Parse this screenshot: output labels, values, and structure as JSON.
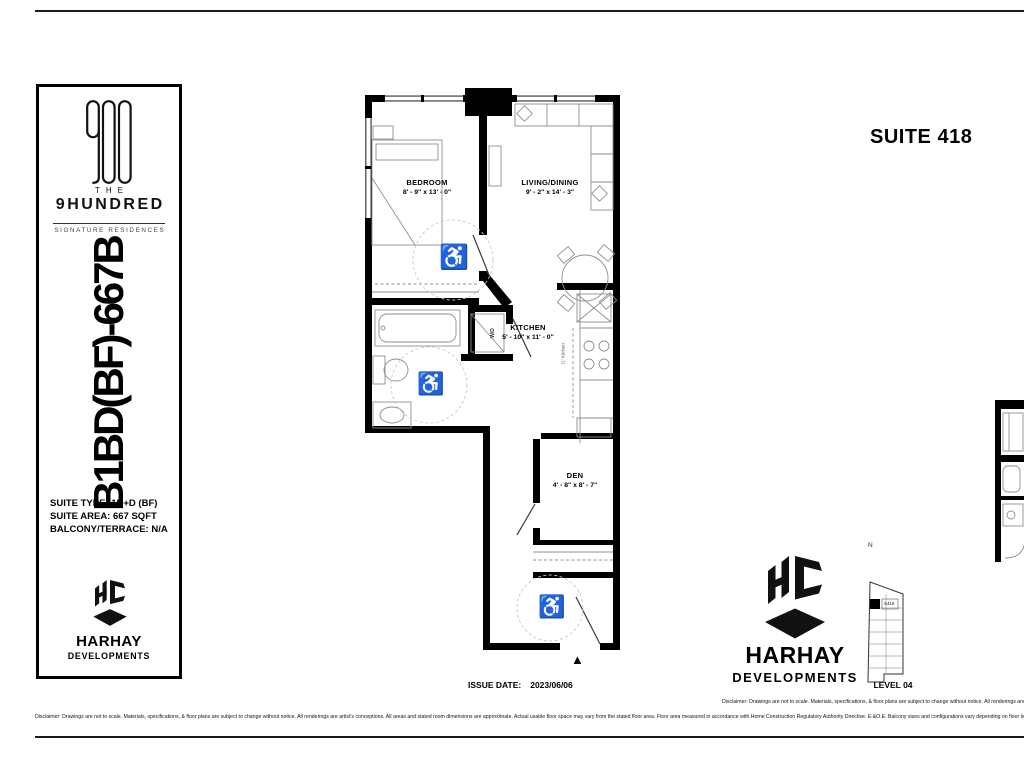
{
  "sheet": {
    "suite_title": "SUITE 418",
    "issue_date_label": "ISSUE DATE:",
    "issue_date_value": "2023/06/06",
    "disclaimer": "Disclaimer: Drawings are not to scale. Materials, specifications, & floor plans are subject to change without notice. All renderings are artist's conceptions. All areas and stated room dimensions are approximate. Actual usable floor space may vary from the stated floor area. Floor area measured in accordance with Home Construction Regulatory Authority Directive. E.&O.E. Balcony sizes and configurations vary depending on floor level locations."
  },
  "sidebar": {
    "brand_the": "THE",
    "brand_name": "9HUNDRED",
    "brand_sub": "SIGNATURE RESIDENCES",
    "plan_code": "B1BD(BF)-667B",
    "suite_type": "SUITE TYPE: 1B+D (BF)",
    "suite_area": "SUITE AREA: 667 SQFT",
    "balcony": "BALCONY/TERRACE: N/A",
    "developer_name": "HARHAY",
    "developer_sub": "DEVELOPMENTS"
  },
  "footer_brand": {
    "developer_name": "HARHAY",
    "developer_sub": "DEVELOPMENTS"
  },
  "floorplan": {
    "rooms": [
      {
        "name": "BEDROOM",
        "dims": "8' - 9\" x 13' - 0\""
      },
      {
        "name": "LIVING/DINING",
        "dims": "9' - 2\" x 14' - 3\""
      },
      {
        "name": "KITCHEN",
        "dims": "5' - 10\" x 11' - 0\""
      },
      {
        "name": "DEN",
        "dims": "4' - 8\" x 8' - 7\""
      }
    ],
    "wd_label": "W/D",
    "kitchen_run_label": "11' Kitchen"
  },
  "keyplan": {
    "north_label": "N",
    "suite_label": "S418",
    "level_label": "LEVEL 04"
  },
  "icons": {
    "wheelchair": "♿",
    "entry_arrow": "▲"
  },
  "colors": {
    "wall": "#000000",
    "furniture_line": "#8f8f8f",
    "accessibility_line": "#c8c8c8"
  }
}
